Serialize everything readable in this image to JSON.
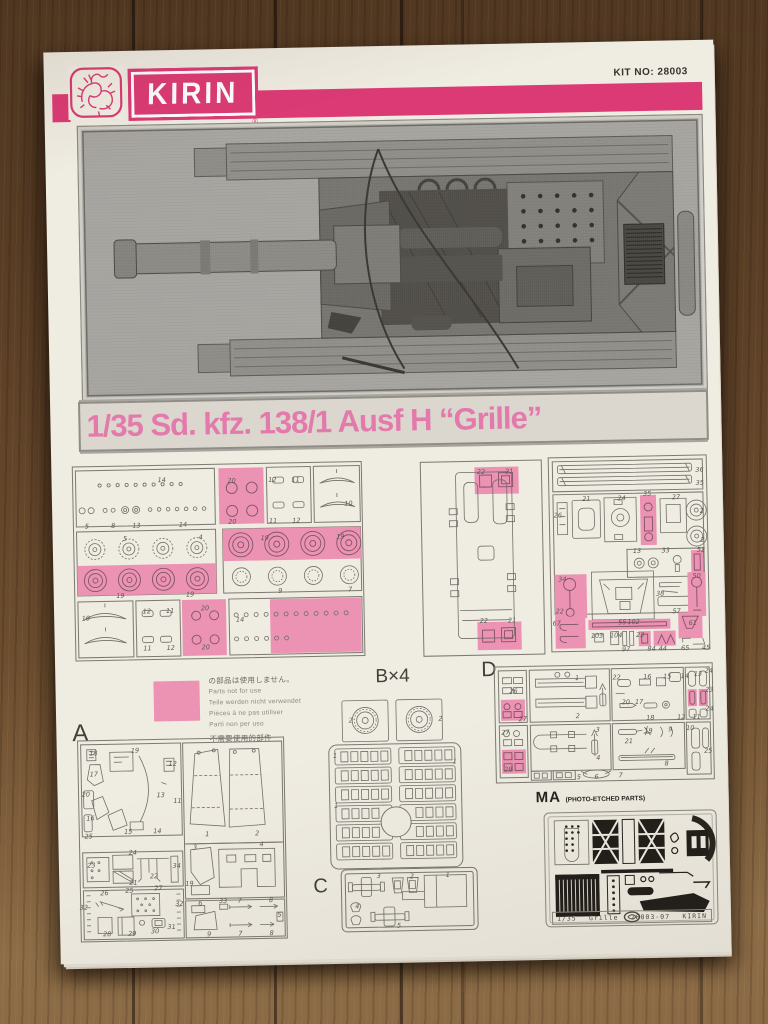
{
  "header": {
    "brand": "KIRIN",
    "registered": "®",
    "kit_no": "KIT NO: 28003"
  },
  "title": "1/35 Sd. kfz. 138/1 Ausf H  “Grille”",
  "colors": {
    "header_pink": "#dc3a74",
    "title_pink": "#e37aab",
    "highlight_pink": "#ec92b2",
    "paper": "#efece2"
  },
  "parts_note": {
    "lines": [
      "の部品は使用しません。",
      "Parts not for use",
      "Teile werden nicht verwendet",
      "Pièces à ne pas utiliser",
      "Parti non per uso",
      "不需要使用的部件"
    ]
  },
  "sections": {
    "a": {
      "label": "A"
    },
    "b": {
      "label": "B×4"
    },
    "c": {
      "label": "C"
    },
    "d": {
      "label": "D"
    },
    "ma": {
      "label": "MA",
      "sublabel": "(PHOTO-ETCHED PARTS)"
    }
  },
  "footer": {
    "scale": "1/35",
    "kit_name": "Grille",
    "part_code": "28003-07",
    "brand": "KIRIN"
  },
  "panels": {
    "wheels": {
      "labels": [
        {
          "t": "14",
          "x": 31,
          "y": 8
        },
        {
          "t": "5",
          "x": 5,
          "y": 31
        },
        {
          "t": "8",
          "x": 14,
          "y": 31
        },
        {
          "t": "13",
          "x": 22,
          "y": 31
        },
        {
          "t": "14",
          "x": 38,
          "y": 31
        },
        {
          "t": "20",
          "x": 55,
          "y": 9
        },
        {
          "t": "20",
          "x": 55,
          "y": 30
        },
        {
          "t": "12",
          "x": 69,
          "y": 9
        },
        {
          "t": "11",
          "x": 77,
          "y": 9
        },
        {
          "t": "11",
          "x": 69,
          "y": 30
        },
        {
          "t": "12",
          "x": 77,
          "y": 30
        },
        {
          "t": "10",
          "x": 95,
          "y": 22
        },
        {
          "t": "5",
          "x": 18,
          "y": 38
        },
        {
          "t": "4",
          "x": 44,
          "y": 38
        },
        {
          "t": "19",
          "x": 16,
          "y": 67
        },
        {
          "t": "19",
          "x": 40,
          "y": 67
        },
        {
          "t": "19",
          "x": 66,
          "y": 39
        },
        {
          "t": "19",
          "x": 92,
          "y": 39
        },
        {
          "t": "9",
          "x": 71,
          "y": 66
        },
        {
          "t": "7",
          "x": 95,
          "y": 66
        },
        {
          "t": "10",
          "x": 4,
          "y": 78
        },
        {
          "t": "12",
          "x": 25,
          "y": 75
        },
        {
          "t": "11",
          "x": 33,
          "y": 75
        },
        {
          "t": "11",
          "x": 25,
          "y": 94
        },
        {
          "t": "12",
          "x": 33,
          "y": 94
        },
        {
          "t": "20",
          "x": 45,
          "y": 74
        },
        {
          "t": "20",
          "x": 45,
          "y": 94
        },
        {
          "t": "14",
          "x": 57,
          "y": 80
        }
      ]
    },
    "hull": {
      "labels": [
        {
          "t": "22",
          "x": 50,
          "y": 6
        },
        {
          "t": "21",
          "x": 73,
          "y": 6
        },
        {
          "t": "22",
          "x": 50,
          "y": 82
        },
        {
          "t": "21",
          "x": 73,
          "y": 82
        }
      ]
    },
    "fittings": {
      "labels": [
        {
          "t": "36",
          "x": 95,
          "y": 8
        },
        {
          "t": "35",
          "x": 95,
          "y": 15
        },
        {
          "t": "26",
          "x": 6,
          "y": 30
        },
        {
          "t": "21",
          "x": 24,
          "y": 22
        },
        {
          "t": "24",
          "x": 46,
          "y": 22
        },
        {
          "t": "35",
          "x": 62,
          "y": 20
        },
        {
          "t": "27",
          "x": 80,
          "y": 22
        },
        {
          "t": "2",
          "x": 96,
          "y": 29
        },
        {
          "t": "2",
          "x": 96,
          "y": 44
        },
        {
          "t": "13",
          "x": 55,
          "y": 49
        },
        {
          "t": "33",
          "x": 73,
          "y": 49
        },
        {
          "t": "52",
          "x": 95,
          "y": 49
        },
        {
          "t": "34",
          "x": 8,
          "y": 63
        },
        {
          "t": "22",
          "x": 6,
          "y": 79
        },
        {
          "t": "55",
          "x": 45,
          "y": 85
        },
        {
          "t": "38",
          "x": 69,
          "y": 71
        },
        {
          "t": "57",
          "x": 79,
          "y": 80
        },
        {
          "t": "50",
          "x": 92,
          "y": 62
        },
        {
          "t": "67",
          "x": 4,
          "y": 85
        },
        {
          "t": "102",
          "x": 52,
          "y": 85
        },
        {
          "t": "103",
          "x": 29,
          "y": 92
        },
        {
          "t": "104",
          "x": 41,
          "y": 92
        },
        {
          "t": "97",
          "x": 47,
          "y": 99
        },
        {
          "t": "23",
          "x": 56,
          "y": 92
        },
        {
          "t": "84",
          "x": 63,
          "y": 99
        },
        {
          "t": "44",
          "x": 70,
          "y": 99
        },
        {
          "t": "65",
          "x": 84,
          "y": 99
        },
        {
          "t": "61",
          "x": 89,
          "y": 86
        },
        {
          "t": "45",
          "x": 97,
          "y": 99
        }
      ]
    },
    "a": {
      "labels": [
        {
          "t": "18",
          "x": 8,
          "y": 7
        },
        {
          "t": "19",
          "x": 28,
          "y": 6
        },
        {
          "t": "17",
          "x": 8,
          "y": 17
        },
        {
          "t": "12",
          "x": 46,
          "y": 13
        },
        {
          "t": "20",
          "x": 4,
          "y": 27
        },
        {
          "t": "13",
          "x": 40,
          "y": 28
        },
        {
          "t": "11",
          "x": 48,
          "y": 31
        },
        {
          "t": "16",
          "x": 6,
          "y": 39
        },
        {
          "t": "15",
          "x": 24,
          "y": 46
        },
        {
          "t": "14",
          "x": 38,
          "y": 46
        },
        {
          "t": "25",
          "x": 5,
          "y": 48
        },
        {
          "t": "1",
          "x": 62,
          "y": 48
        },
        {
          "t": "2",
          "x": 86,
          "y": 48
        },
        {
          "t": "23",
          "x": 6,
          "y": 62
        },
        {
          "t": "24",
          "x": 26,
          "y": 56
        },
        {
          "t": "21",
          "x": 26,
          "y": 71
        },
        {
          "t": "22",
          "x": 36,
          "y": 68
        },
        {
          "t": "34",
          "x": 47,
          "y": 63
        },
        {
          "t": "3",
          "x": 56,
          "y": 54
        },
        {
          "t": "4",
          "x": 88,
          "y": 53
        },
        {
          "t": "19",
          "x": 53,
          "y": 72
        },
        {
          "t": "26",
          "x": 12,
          "y": 76
        },
        {
          "t": "25",
          "x": 24,
          "y": 75
        },
        {
          "t": "27",
          "x": 38,
          "y": 74
        },
        {
          "t": "32",
          "x": 2,
          "y": 83
        },
        {
          "t": "32",
          "x": 48,
          "y": 82
        },
        {
          "t": "28",
          "x": 13,
          "y": 96
        },
        {
          "t": "29",
          "x": 25,
          "y": 96
        },
        {
          "t": "30",
          "x": 36,
          "y": 95
        },
        {
          "t": "31",
          "x": 44,
          "y": 93
        },
        {
          "t": "6",
          "x": 58,
          "y": 82
        },
        {
          "t": "33",
          "x": 69,
          "y": 81
        },
        {
          "t": "7",
          "x": 77,
          "y": 81
        },
        {
          "t": "8",
          "x": 92,
          "y": 81
        },
        {
          "t": "9",
          "x": 62,
          "y": 97
        },
        {
          "t": "7",
          "x": 77,
          "y": 97
        },
        {
          "t": "8",
          "x": 92,
          "y": 97
        },
        {
          "t": "5",
          "x": 96,
          "y": 88
        }
      ]
    },
    "b": {
      "labels": [
        {
          "t": "2",
          "x": 18,
          "y": 13
        },
        {
          "t": "2",
          "x": 84,
          "y": 13
        },
        {
          "t": "1",
          "x": 6,
          "y": 33
        },
        {
          "t": "1",
          "x": 94,
          "y": 38
        },
        {
          "t": "1",
          "x": 6,
          "y": 62
        }
      ]
    },
    "c": {
      "labels": [
        {
          "t": "3",
          "x": 28,
          "y": 12
        },
        {
          "t": "2",
          "x": 52,
          "y": 14
        },
        {
          "t": "1",
          "x": 78,
          "y": 12
        },
        {
          "t": "4",
          "x": 12,
          "y": 60
        },
        {
          "t": "5",
          "x": 42,
          "y": 90
        }
      ]
    },
    "d": {
      "labels": [
        {
          "t": "26",
          "x": 9,
          "y": 22
        },
        {
          "t": "27",
          "x": 13,
          "y": 46
        },
        {
          "t": "27",
          "x": 5,
          "y": 57
        },
        {
          "t": "28",
          "x": 6,
          "y": 88
        },
        {
          "t": "1",
          "x": 38,
          "y": 12
        },
        {
          "t": "2",
          "x": 38,
          "y": 44
        },
        {
          "t": "22",
          "x": 56,
          "y": 12
        },
        {
          "t": "20",
          "x": 60,
          "y": 33
        },
        {
          "t": "16",
          "x": 70,
          "y": 12
        },
        {
          "t": "15",
          "x": 79,
          "y": 12
        },
        {
          "t": "14",
          "x": 87,
          "y": 12
        },
        {
          "t": "13",
          "x": 93,
          "y": 10
        },
        {
          "t": "17",
          "x": 66,
          "y": 33
        },
        {
          "t": "18",
          "x": 71,
          "y": 47
        },
        {
          "t": "12",
          "x": 85,
          "y": 47
        },
        {
          "t": "11",
          "x": 92,
          "y": 47
        },
        {
          "t": "24",
          "x": 98,
          "y": 8
        },
        {
          "t": "23",
          "x": 98,
          "y": 24
        },
        {
          "t": "24",
          "x": 98,
          "y": 40
        },
        {
          "t": "25",
          "x": 97,
          "y": 75
        },
        {
          "t": "3",
          "x": 47,
          "y": 56
        },
        {
          "t": "4",
          "x": 47,
          "y": 80
        },
        {
          "t": "21",
          "x": 61,
          "y": 66
        },
        {
          "t": "19",
          "x": 70,
          "y": 58
        },
        {
          "t": "9",
          "x": 80,
          "y": 57
        },
        {
          "t": "10",
          "x": 89,
          "y": 56
        },
        {
          "t": "8",
          "x": 78,
          "y": 86
        },
        {
          "t": "5",
          "x": 38,
          "y": 96
        },
        {
          "t": "6",
          "x": 46,
          "y": 96
        },
        {
          "t": "7",
          "x": 57,
          "y": 95
        }
      ]
    }
  }
}
